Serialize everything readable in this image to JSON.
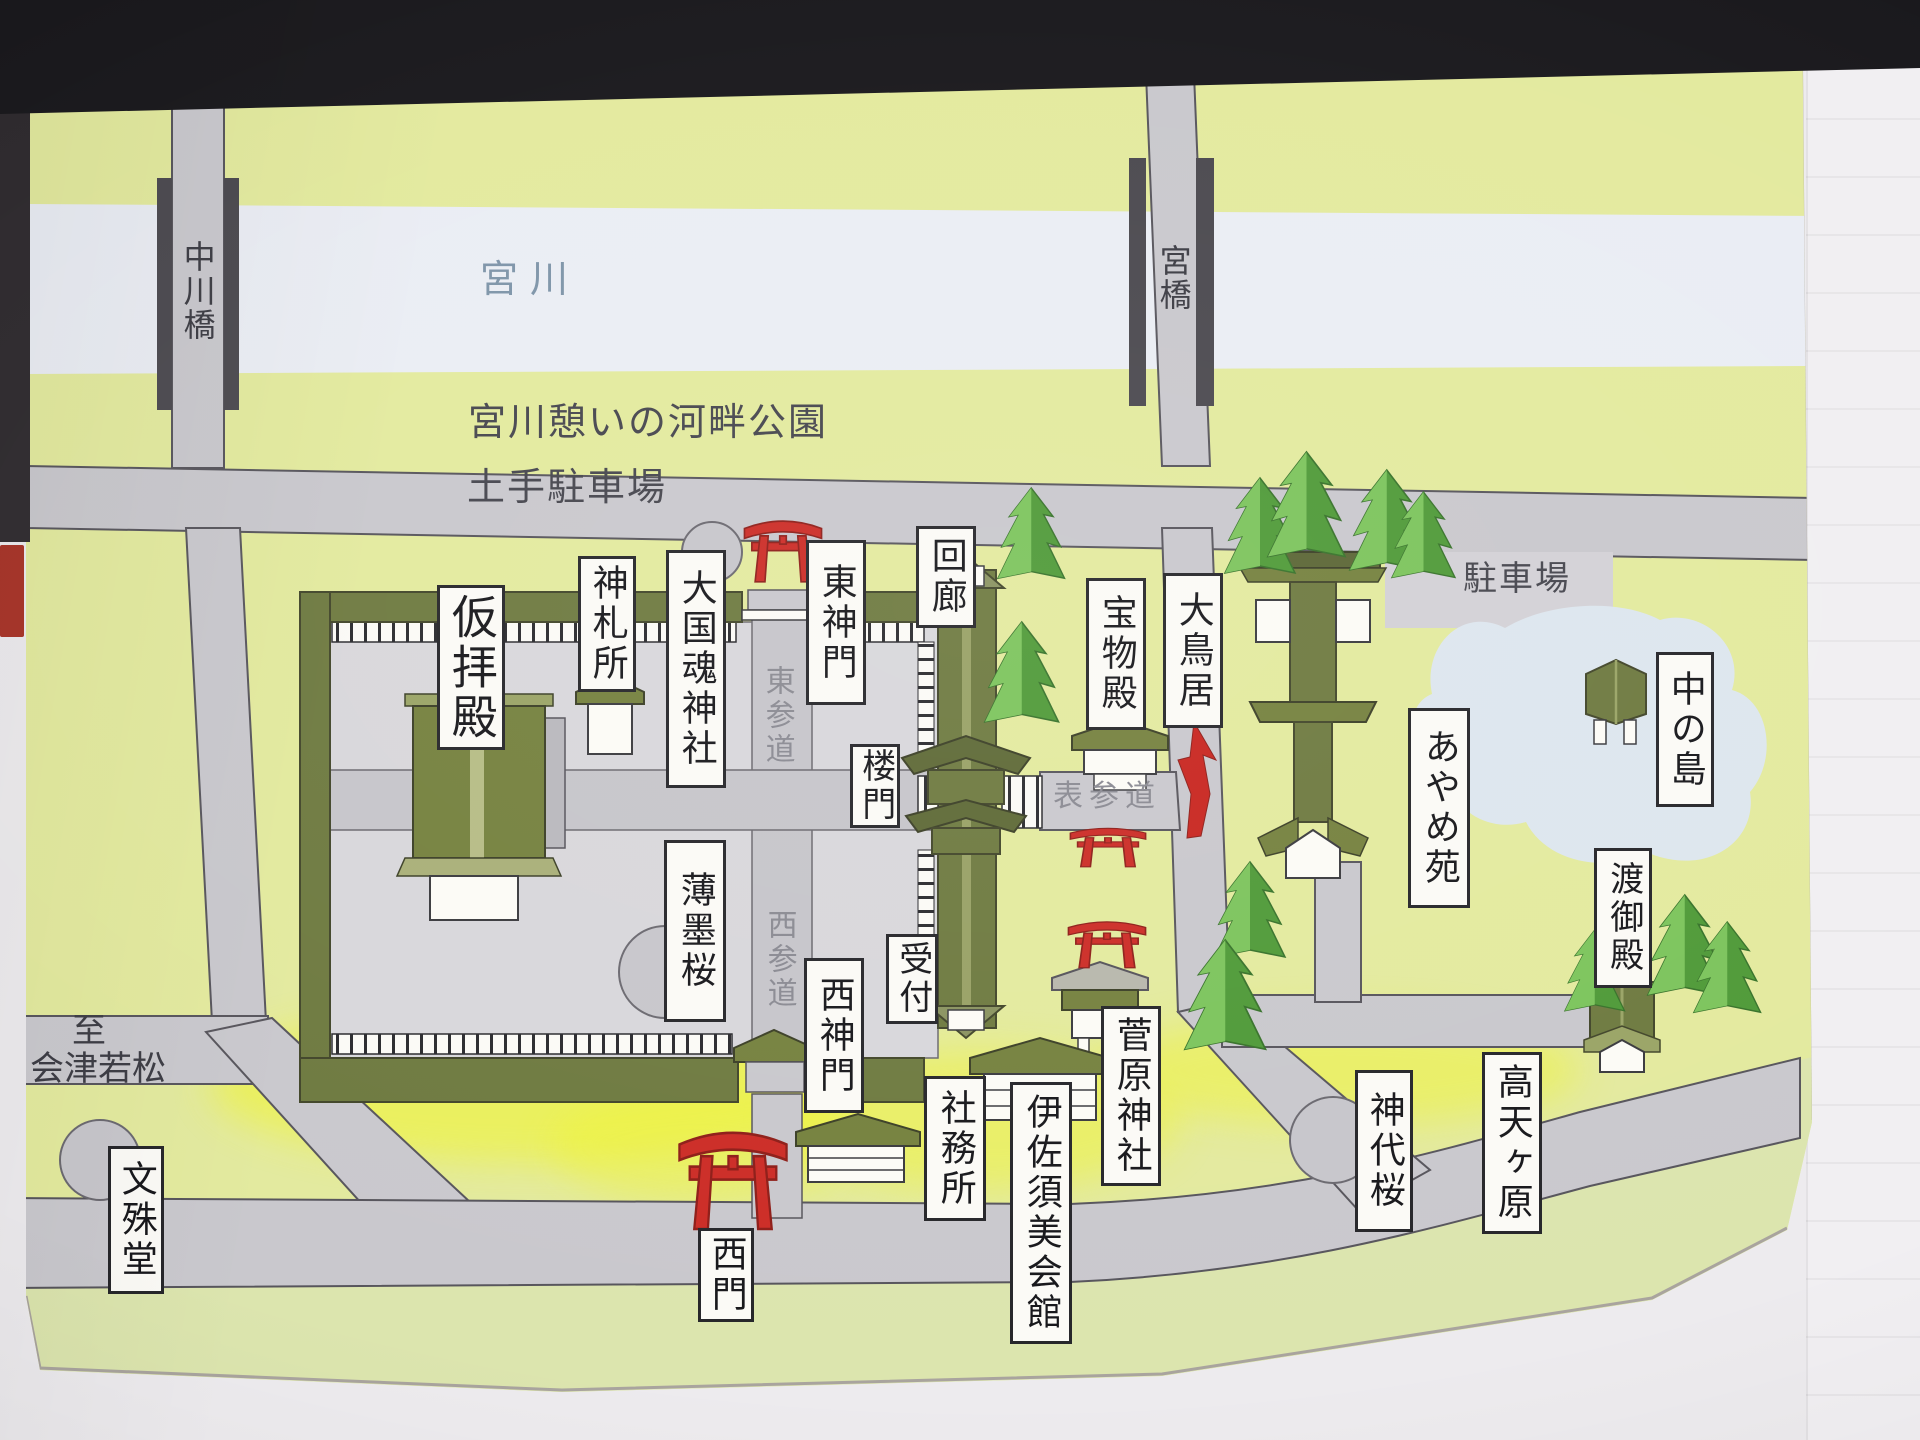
{
  "map": {
    "labels": {
      "kari_haiden": "仮拝殿",
      "shinsatsusho": "神札所",
      "okunitama_jinja": "大国魂神社",
      "higashi_shinmon": "東神門",
      "kairo": "回廊",
      "homotsuden": "宝物殿",
      "otorii": "大鳥居",
      "romon": "楼門",
      "usuzumi_zakura": "薄墨桜",
      "uketsuke": "受付",
      "nishi_shinmon": "西神門",
      "shamusho": "社務所",
      "isasumi_kaikan": "伊佐須美会館",
      "sugawara_jinja": "菅原神社",
      "nishimon": "西門",
      "monjudo": "文殊堂",
      "ayameen": "あやめ苑",
      "nakanoshima": "中の島",
      "togyoden": "渡御殿",
      "jindai_zakura": "神代桜",
      "takamagahara": "高天ヶ原",
      "miyakawa": "宮川",
      "nakagawabashi": "中川橋",
      "miyabashi": "宮橋",
      "kahan_koen": "宮川憩いの河畔公園",
      "dote_chushajo": "土手駐車場",
      "chushajo": "駐車場",
      "higashi_sando": "東参道",
      "nishi_sando": "西参道",
      "omote_sando": "表参道",
      "itaru": "至",
      "aizu_wakamatsu": "会津若松"
    },
    "colors": {
      "map_bg": "#e3ea9e",
      "road_gray": "#c9c8cd",
      "river_blue": "#eaedf4",
      "pond_blue": "#dde6ee",
      "courtyard_gray": "#d8d7db",
      "wall_olive": "#6e7a40",
      "roof_olive": "#75813e",
      "torii_red": "#cc2c26",
      "arrow_red": "#c8251f",
      "highlight_yellow": "#f0f433",
      "tree_dark": "#4f9a38",
      "tree_light": "#7cc45c"
    }
  }
}
